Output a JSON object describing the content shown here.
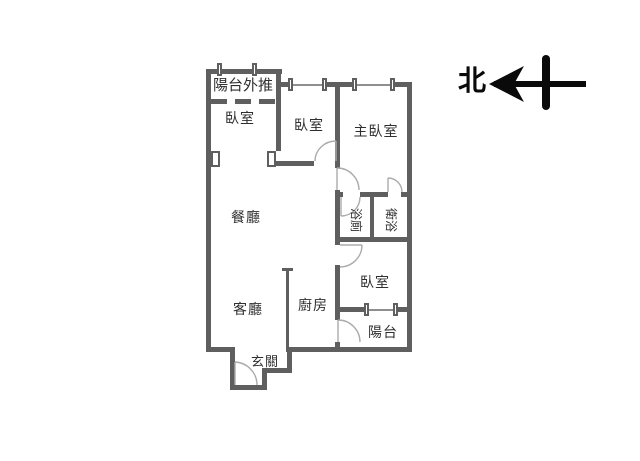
{
  "title": "apartment-floor-plan",
  "compass": {
    "label": "北",
    "arrow_direction": "left"
  },
  "rooms": {
    "balcony_pushout": "陽台外推",
    "bedroom_top_left": "臥室",
    "bedroom_top_middle": "臥室",
    "master_bedroom": "主臥室",
    "dining_room": "餐廳",
    "living_room": "客廳",
    "kitchen": "廚房",
    "bedroom_right": "臥室",
    "balcony": "陽台",
    "entry": "玄關",
    "bathroom": "浴廁",
    "master_bathroom": "衛浴"
  },
  "colors": {
    "wall": "#5f5f5f",
    "window_line": "#8f8f8f",
    "door_arc": "#ababab",
    "text": "#2f2f2f",
    "compass": "#0a0a0a",
    "background": "#ffffff"
  }
}
